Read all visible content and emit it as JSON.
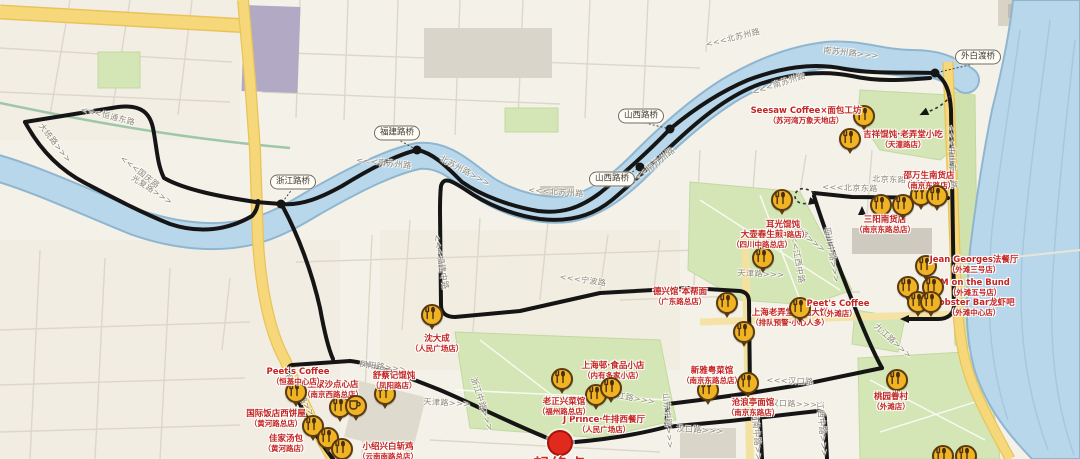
{
  "colors": {
    "land": "#f4f1e8",
    "water_fill": "#b9d7ea",
    "water_edge": "#8fb6d0",
    "green": "#d4e6b6",
    "yellow_road": "#f6d87b",
    "route_black": "#151515",
    "poi_gold": "#f0b324",
    "poi_border": "#5a3a10",
    "label_red": "#c32421",
    "start_red": "#e02a1e"
  },
  "start": {
    "x": 560,
    "y": 443,
    "label": "起终点"
  },
  "streets": [
    {
      "text": "<<<恒通东路",
      "x": 108,
      "y": 116,
      "rot": 14
    },
    {
      "text": "大统路>>>",
      "x": 55,
      "y": 143,
      "rot": 52
    },
    {
      "text": "光复路>>>",
      "x": 152,
      "y": 190,
      "rot": 33
    },
    {
      "text": "<<<国庆路",
      "x": 140,
      "y": 172,
      "rot": 38
    },
    {
      "text": "<<<南苏州路",
      "x": 384,
      "y": 163,
      "rot": 6
    },
    {
      "text": "北苏州路>>>",
      "x": 465,
      "y": 171,
      "rot": 28
    },
    {
      "text": "<<<北苏州路",
      "x": 556,
      "y": 192,
      "rot": 4
    },
    {
      "text": "<<<南苏州路",
      "x": 652,
      "y": 166,
      "rot": -37
    },
    {
      "text": "<<<北苏州路",
      "x": 733,
      "y": 38,
      "rot": -14
    },
    {
      "text": "南苏州路>>>",
      "x": 851,
      "y": 53,
      "rot": 6
    },
    {
      "text": "<<<南苏州路",
      "x": 779,
      "y": 84,
      "rot": -18
    },
    {
      "text": "<<<中山东一路",
      "x": 952,
      "y": 157,
      "rot": 87
    },
    {
      "text": "<<<宁波路",
      "x": 583,
      "y": 280,
      "rot": 8
    },
    {
      "text": "宁波路>>>",
      "x": 806,
      "y": 236,
      "rot": 38
    },
    {
      "text": "<<<江西中路",
      "x": 797,
      "y": 256,
      "rot": 80
    },
    {
      "text": "四川中路>>>",
      "x": 832,
      "y": 255,
      "rot": 80
    },
    {
      "text": "<<<北京东路",
      "x": 850,
      "y": 188,
      "rot": 2
    },
    {
      "text": "北京东路>>>",
      "x": 900,
      "y": 180,
      "rot": 2
    },
    {
      "text": "<<<汉口路",
      "x": 790,
      "y": 381,
      "rot": 2
    },
    {
      "text": "汉口路>>>",
      "x": 794,
      "y": 404,
      "rot": 2
    },
    {
      "text": "汉口路>>>",
      "x": 700,
      "y": 430,
      "rot": 3
    },
    {
      "text": "九江路>>>",
      "x": 632,
      "y": 398,
      "rot": 10
    },
    {
      "text": "九江路>>>",
      "x": 893,
      "y": 341,
      "rot": 42
    },
    {
      "text": "天津路>>>",
      "x": 447,
      "y": 403,
      "rot": 3
    },
    {
      "text": "天津路>>>",
      "x": 761,
      "y": 274,
      "rot": 2
    },
    {
      "text": "凤阳路>>>",
      "x": 383,
      "y": 367,
      "rot": 7
    },
    {
      "text": "浙江中路>>>",
      "x": 482,
      "y": 404,
      "rot": 72
    },
    {
      "text": "山东中路>>>",
      "x": 668,
      "y": 421,
      "rot": 85
    },
    {
      "text": "河南中路>>>",
      "x": 757,
      "y": 440,
      "rot": 85
    },
    {
      "text": "江西中路>>>",
      "x": 822,
      "y": 429,
      "rot": 85
    },
    {
      "text": "<<<福建中路",
      "x": 441,
      "y": 262,
      "rot": 80
    },
    {
      "text": "西藏中路>>>",
      "x": 302,
      "y": 398,
      "rot": 58
    }
  ],
  "bridges": [
    {
      "name": "浙江路桥",
      "px": 293,
      "py": 182,
      "dx": 281,
      "dy": 204
    },
    {
      "name": "福建路桥",
      "px": 397,
      "py": 133,
      "dx": 417,
      "dy": 150
    },
    {
      "name": "山西路桥",
      "px": 641,
      "py": 116,
      "dx": 670,
      "dy": 129
    },
    {
      "name": "山西路桥",
      "px": 612,
      "py": 179,
      "dx": 640,
      "dy": 167
    },
    {
      "name": "外白渡桥",
      "px": 978,
      "py": 57,
      "dx": 935,
      "dy": 73
    }
  ],
  "pois": [
    {
      "x": 864,
      "y": 116,
      "icon": "fork",
      "name": "Seesaw Coffee×面包工坊",
      "branch": "（苏河湾万象天地店）",
      "lx": 806,
      "ly": 116
    },
    {
      "x": 850,
      "y": 139,
      "icon": "fork",
      "name": "吉祥馄饨·老弄堂小吃",
      "branch": "（天潼路店）",
      "lx": 903,
      "ly": 140
    },
    {
      "x": 782,
      "y": 200,
      "icon": "fork",
      "name": "耳光馄饨",
      "branch": "（江西中路店）",
      "lx": 783,
      "ly": 230
    },
    {
      "x": 881,
      "y": 205,
      "icon": "fork",
      "name": "三阳南货店",
      "branch": "（南京东路总店）",
      "lx": 885,
      "ly": 225
    },
    {
      "x": 903,
      "y": 205,
      "icon": "fork"
    },
    {
      "x": 921,
      "y": 195,
      "icon": "fork",
      "name": "邵万生南货店",
      "branch": "（南京东路店）",
      "lx": 929,
      "ly": 181
    },
    {
      "x": 937,
      "y": 196,
      "icon": "fork"
    },
    {
      "x": 926,
      "y": 266,
      "icon": "fork",
      "name": "Jean Georges法餐厅",
      "branch": "（外滩三号店）",
      "lx": 974,
      "ly": 265
    },
    {
      "x": 908,
      "y": 287,
      "icon": "fork",
      "name": "M on the Bund",
      "branch": "（外滩五号店）",
      "lx": 975,
      "ly": 288
    },
    {
      "x": 933,
      "y": 287,
      "icon": "fork"
    },
    {
      "x": 918,
      "y": 302,
      "icon": "fork",
      "name": "Lobster Bar龙虾吧",
      "branch": "（外滩中心店）",
      "lx": 974,
      "ly": 308
    },
    {
      "x": 931,
      "y": 302,
      "icon": "fork"
    },
    {
      "x": 763,
      "y": 258,
      "icon": "fork",
      "name": "大壶春生煎",
      "branch": "（四川中路总店）",
      "lx": 762,
      "ly": 240
    },
    {
      "x": 727,
      "y": 303,
      "icon": "fork",
      "name": "德兴馆·本帮面",
      "branch": "（广东路总店）",
      "lx": 680,
      "ly": 297
    },
    {
      "x": 744,
      "y": 332,
      "icon": "fork",
      "name": "上海老弄堂葱油大饼",
      "branch": "（排队预警·小心人多）",
      "lx": 790,
      "ly": 318
    },
    {
      "x": 800,
      "y": 308,
      "icon": "fork",
      "name": "Peet's Coffee",
      "branch": "（外滩店）",
      "lx": 838,
      "ly": 309
    },
    {
      "x": 562,
      "y": 379,
      "icon": "fork",
      "name": "上海邨·食品小店",
      "branch": "（内有多家小店）",
      "lx": 613,
      "ly": 371
    },
    {
      "x": 596,
      "y": 395,
      "icon": "fork",
      "name": "J Prince·牛排西餐厅",
      "branch": "（人民广场店）",
      "lx": 604,
      "ly": 425
    },
    {
      "x": 611,
      "y": 388,
      "icon": "fork",
      "name": "老正兴菜馆",
      "branch": "（福州路总店）",
      "lx": 564,
      "ly": 407
    },
    {
      "x": 432,
      "y": 315,
      "icon": "fork",
      "name": "沈大成",
      "branch": "（人民广场店）",
      "lx": 437,
      "ly": 344
    },
    {
      "x": 340,
      "y": 407,
      "icon": "fork",
      "name": "王家沙点心店",
      "branch": "（南京西路总店）",
      "lx": 333,
      "ly": 390
    },
    {
      "x": 356,
      "y": 406,
      "icon": "cup"
    },
    {
      "x": 385,
      "y": 394,
      "icon": "fork",
      "name": "舒蔡记馄饨",
      "branch": "（凤阳路店）",
      "lx": 394,
      "ly": 381
    },
    {
      "x": 296,
      "y": 392,
      "icon": "fork",
      "name": "Peet's Coffee",
      "branch": "（恒基中心店）",
      "lx": 298,
      "ly": 377
    },
    {
      "x": 313,
      "y": 426,
      "icon": "fork",
      "name": "国际饭店西饼屋",
      "branch": "（黄河路总店）",
      "lx": 276,
      "ly": 419
    },
    {
      "x": 328,
      "y": 438,
      "icon": "fork",
      "name": "佳家汤包",
      "branch": "（黄河路店）",
      "lx": 286,
      "ly": 444
    },
    {
      "x": 342,
      "y": 449,
      "icon": "fork",
      "name": "小绍兴白斩鸡",
      "branch": "（云南南路总店）",
      "lx": 388,
      "ly": 452
    },
    {
      "x": 708,
      "y": 390,
      "icon": "fork",
      "name": "新雅粤菜馆",
      "branch": "（南京东路总店）",
      "lx": 712,
      "ly": 376
    },
    {
      "x": 748,
      "y": 383,
      "icon": "fork",
      "name": "沧浪亭面馆",
      "branch": "（南京东路店）",
      "lx": 753,
      "ly": 408
    },
    {
      "x": 897,
      "y": 380,
      "icon": "fork",
      "name": "桃园眷村",
      "branch": "（外滩店）",
      "lx": 891,
      "ly": 402
    },
    {
      "x": 943,
      "y": 456,
      "icon": "fork"
    },
    {
      "x": 966,
      "y": 456,
      "icon": "fork"
    }
  ],
  "direction_arrows": [
    {
      "x": 862,
      "y": 211,
      "rot": 0
    },
    {
      "x": 924,
      "y": 113,
      "rot": -115
    },
    {
      "x": 905,
      "y": 319,
      "rot": -90
    },
    {
      "x": 813,
      "y": 202,
      "rot": 105
    }
  ]
}
